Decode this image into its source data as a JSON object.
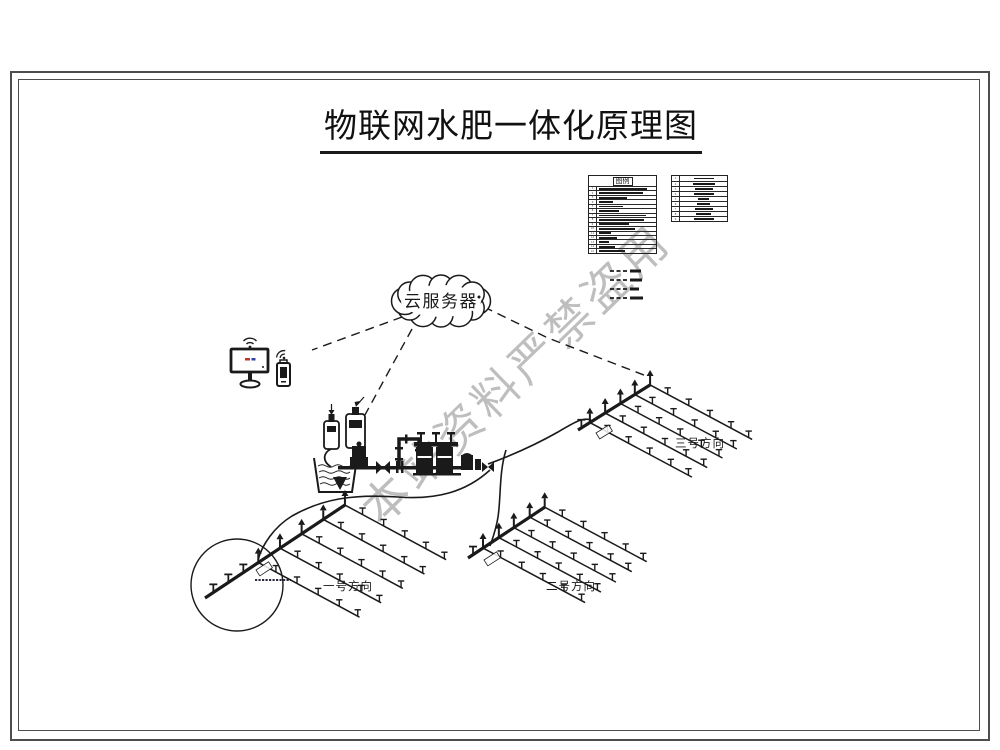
{
  "title": "物联网水肥一体化原理图",
  "watermark": "本站资料严禁盗用",
  "cloud_label": "云服务器",
  "legend": {
    "header": "图例",
    "left_rows": [
      {
        "n": "1",
        "w": 48
      },
      {
        "n": "2",
        "w": 44
      },
      {
        "n": "3",
        "w": 28
      },
      {
        "n": "4",
        "w": 14
      },
      {
        "n": "5",
        "w": 24
      },
      {
        "n": "6",
        "w": 20
      },
      {
        "n": "7",
        "w": 47
      },
      {
        "n": "8",
        "w": 45
      },
      {
        "n": "9",
        "w": 30
      },
      {
        "n": "10",
        "w": 36
      },
      {
        "n": "11",
        "w": 12
      },
      {
        "n": "12",
        "w": 18
      },
      {
        "n": "13",
        "w": 10
      },
      {
        "n": "14",
        "w": 16
      },
      {
        "n": "15",
        "w": 26
      }
    ],
    "right_rows": [
      {
        "n": "1",
        "w": 20
      },
      {
        "n": "2",
        "w": 22
      },
      {
        "n": "3",
        "w": 18
      },
      {
        "n": "4",
        "w": 20
      },
      {
        "n": "5",
        "w": 11
      },
      {
        "n": "6",
        "w": 13
      },
      {
        "n": "7",
        "w": 18
      },
      {
        "n": "8",
        "w": 15
      },
      {
        "n": "9",
        "w": 20
      }
    ],
    "line_items": [
      {
        "w": 11
      },
      {
        "w": 12
      },
      {
        "w": 9
      },
      {
        "w": 13
      }
    ]
  },
  "fields": [
    {
      "label": "一号方向"
    },
    {
      "label": "二号方向"
    },
    {
      "label": "三号方向"
    }
  ],
  "colors": {
    "ink": "#1a1a1a",
    "watermark": "#949494",
    "frame": "#4d4d4d",
    "background": "#ffffff"
  }
}
